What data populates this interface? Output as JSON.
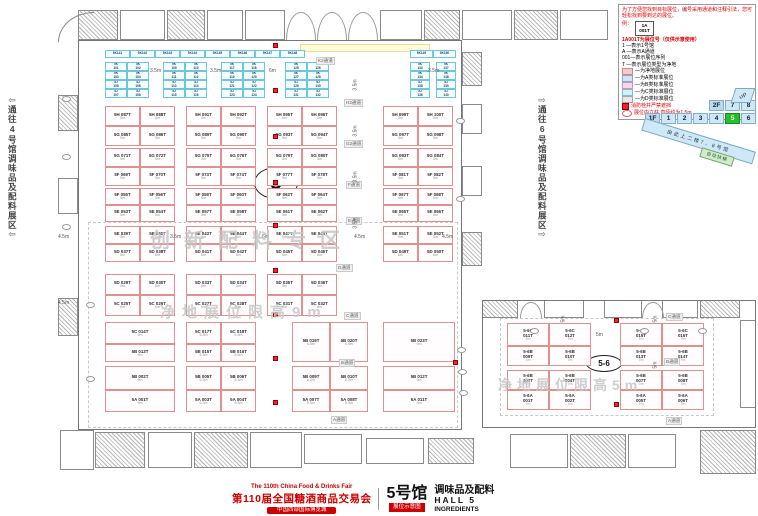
{
  "title_bar": {
    "fair_en": "The 110th China Food & Drinks Fair",
    "fair_cn": "第110届全国糖酒商品交易会",
    "venue": "中国西部国际博览城",
    "hall_big": "5号馆",
    "badge": "展位示意图",
    "hall_cn": "调味品及配料",
    "hall_en": "HALL 5",
    "hall_sub": "INGREDIENTS"
  },
  "corridors": {
    "left": "通往4号馆调味品及配料展区",
    "right": "通往6号馆调味品及配料展区",
    "left_arrow": "⇦",
    "right_arrow": "⇨"
  },
  "hall_marks": {
    "main": "5",
    "connector": "5-6"
  },
  "legend": {
    "intro": "为了方便您找到目标展位，编号采用通道和注释引法，您可轻松找到要到达的展位。",
    "example_label": "例：",
    "example_line1": "1A",
    "example_line2": "001T",
    "title": "1A001T为展位号（仅供示意使用）",
    "code_lines": [
      "1 —表示1号馆",
      "A —表示A通道",
      "001—表示展位序列",
      "T —表示展位类型为净地"
    ],
    "key": [
      {
        "c": "#f6caca",
        "b": "#d08888",
        "t": "—为净地展位"
      },
      {
        "c": "#cfe6f7",
        "b": "#88a8c8",
        "t": "—为A类标准展位"
      },
      {
        "c": "#fbd7e9",
        "b": "#d391b4",
        "t": "—为B类标准展位"
      },
      {
        "c": "#d4f3f8",
        "b": "#7fbccc",
        "t": "—为C类标准展位"
      },
      {
        "c": "#e9e9e9",
        "b": "#a8a8a8",
        "t": "—为D类标准展位"
      }
    ],
    "fire_note": "消防栓井严禁遮挡",
    "pillar_note": "展位内立柱 直径约为1.5m"
  },
  "floor_nav": {
    "row1_label": "2F",
    "row1": [
      "7",
      "8"
    ],
    "row2_label": "1F",
    "row2": [
      "1",
      "2",
      "3",
      "4",
      "5",
      "6"
    ],
    "active": "5",
    "active_color": "#22c32a"
  },
  "ramp": {
    "banner": "由此上二楼7、8号馆",
    "escalator": "自动扶梯",
    "up": "up"
  },
  "watermarks": [
    {
      "text": "创新配料专区",
      "x": 150,
      "y": 224,
      "fs": 20,
      "ls": 14
    },
    {
      "text": "净地展位限高9m",
      "x": 160,
      "y": 301,
      "fs": 15,
      "ls": 7
    },
    {
      "text": "净地展位限高5m",
      "x": 498,
      "y": 375,
      "fs": 14,
      "ls": 5
    }
  ],
  "aisles": [
    {
      "t": "K2通道",
      "x": 316,
      "y": 57
    },
    {
      "t": "H2通道",
      "x": 344,
      "y": 99
    },
    {
      "t": "G2通道",
      "x": 344,
      "y": 140
    },
    {
      "t": "F通道",
      "x": 346,
      "y": 181
    },
    {
      "t": "E通道",
      "x": 346,
      "y": 217
    },
    {
      "t": "D通道",
      "x": 336,
      "y": 264
    },
    {
      "t": "C通道",
      "x": 344,
      "y": 312
    },
    {
      "t": "B通道",
      "x": 339,
      "y": 359
    },
    {
      "t": "A通道",
      "x": 331,
      "y": 416
    },
    {
      "t": "C通道",
      "x": 666,
      "y": 313
    },
    {
      "t": "B通道",
      "x": 664,
      "y": 358
    },
    {
      "t": "A通道",
      "x": 666,
      "y": 417
    }
  ],
  "measures": [
    {
      "t": "3.5m",
      "x": 150,
      "y": 68
    },
    {
      "t": "3.5m",
      "x": 210,
      "y": 68
    },
    {
      "t": "6m",
      "x": 269,
      "y": 68
    },
    {
      "t": "3.5m",
      "x": 428,
      "y": 68
    },
    {
      "t": "4.5m",
      "x": 58,
      "y": 234
    },
    {
      "t": "3.5m",
      "x": 170,
      "y": 234
    },
    {
      "t": "6m",
      "x": 262,
      "y": 234
    },
    {
      "t": "4.5m",
      "x": 354,
      "y": 234
    },
    {
      "t": "4.5m",
      "x": 442,
      "y": 234
    },
    {
      "t": "5m",
      "x": 596,
      "y": 332
    },
    {
      "t": "4.5m",
      "x": 58,
      "y": 300
    }
  ],
  "vmeasures": [
    {
      "t": "3.5m",
      "x": 350,
      "y": 82
    },
    {
      "t": "3.5m",
      "x": 350,
      "y": 128
    },
    {
      "t": "3.5m",
      "x": 350,
      "y": 174
    },
    {
      "t": "3.5m",
      "x": 350,
      "y": 220
    },
    {
      "t": "5m",
      "x": 652,
      "y": 316
    },
    {
      "t": "5m",
      "x": 652,
      "y": 362
    },
    {
      "t": "5m",
      "x": 560,
      "y": 316
    }
  ],
  "plan": {
    "groups_x": [
      105,
      186,
      267,
      383
    ],
    "cell_w": 35,
    "bands": [
      {
        "y": 106,
        "rh": 20,
        "rows": [
          {
            "p": "5H",
            "s": "5m",
            "g": [
              [
                "087T",
                "088T"
              ],
              [
                "091T",
                "092T"
              ],
              [
                "095T",
                "096T"
              ],
              [
                "099T",
                "100T"
              ]
            ]
          },
          {
            "p": "5G",
            "s": "5m",
            "g": [
              [
                "085T",
                "086T"
              ],
              [
                "089T",
                "090T"
              ],
              [
                "093T",
                "094T"
              ],
              [
                "097T",
                "098T"
              ]
            ]
          }
        ]
      },
      {
        "y": 148,
        "rh": 19,
        "rows": [
          {
            "p": "5G",
            "s": "5m",
            "g": [
              [
                "071T",
                "072T"
              ],
              [
                "075T",
                "076T"
              ],
              [
                "079T",
                "080T"
              ],
              [
                "083T",
                "084T"
              ]
            ]
          },
          {
            "p": "5F",
            "s": "5m",
            "g": [
              [
                "069T",
                "070T"
              ],
              [
                "073T",
                "074T"
              ],
              [
                "077T",
                "078T"
              ],
              [
                "081T",
                "082T"
              ]
            ]
          }
        ]
      },
      {
        "y": 188,
        "rh": 17,
        "rows": [
          {
            "p": "5F",
            "s": "5m",
            "g": [
              [
                "055T",
                "056T"
              ],
              [
                "059T",
                "060T"
              ],
              [
                "063T",
                "064T"
              ],
              [
                "067T",
                "068T"
              ]
            ]
          },
          {
            "p": "5E",
            "s": "5m",
            "g": [
              [
                "053T",
                "054T"
              ],
              [
                "057T",
                "058T"
              ],
              [
                "061T",
                "062T"
              ],
              [
                "065T",
                "066T"
              ]
            ]
          }
        ]
      },
      {
        "y": 226,
        "rh": 18,
        "rows": [
          {
            "p": "5E",
            "s": "5m",
            "g": [
              [
                "039T",
                "040T"
              ],
              [
                "043T",
                "044T"
              ],
              [
                "047T",
                "048T"
              ],
              [
                "051T",
                "052T"
              ]
            ]
          },
          {
            "p": "5D",
            "s": "6m",
            "g": [
              [
                "037T",
                "038T"
              ],
              [
                "041T",
                "042T"
              ],
              [
                "045T",
                "046T"
              ],
              [
                "049T",
                "050T"
              ]
            ]
          }
        ]
      },
      {
        "y": 274,
        "rh": 21,
        "rows": [
          {
            "p": "5D",
            "s": "5m",
            "g": [
              [
                "029T",
                "030T"
              ],
              [
                "033T",
                "034T"
              ],
              [
                "035T",
                "036T"
              ],
              []
            ]
          },
          {
            "p": "5C",
            "s": "6m",
            "g": [
              [
                "025T",
                "026T"
              ],
              [
                "027T",
                "028T"
              ],
              [
                "031T",
                "032T"
              ],
              []
            ]
          }
        ]
      }
    ],
    "bottom": [
      {
        "x": 105,
        "w": 70,
        "cells": [
          {
            "p": "5C",
            "n": "014T",
            "y": 322,
            "h": 22,
            "s": "9m"
          },
          {
            "p": "5B",
            "n": "013T",
            "y": 344,
            "h": 18,
            "s": "9m"
          },
          {
            "p": "5B",
            "n": "002T",
            "y": 366,
            "h": 24,
            "s": "9m"
          },
          {
            "p": "5A",
            "n": "001T",
            "y": 390,
            "h": 22,
            "s": "9m"
          }
        ]
      },
      {
        "x": 186,
        "w": 70,
        "cols": [
          {
            "p": "5C",
            "a": "017T",
            "b": "018T",
            "y": 322,
            "h": 22,
            "s": "6.5m"
          },
          {
            "p": "5B",
            "a": "015T",
            "b": "016T",
            "y": 344,
            "h": 18,
            "s": "6.5m"
          },
          {
            "p": "5B",
            "a": "005T",
            "b": "006T",
            "y": 366,
            "h": 24,
            "s": "6.5m"
          },
          {
            "p": "5A",
            "a": "003T",
            "b": "004T",
            "y": 390,
            "h": 22,
            "s": "6.5m"
          }
        ]
      },
      {
        "x": 292,
        "w": 76,
        "cols": [
          {
            "p": "5B",
            "a": "019T",
            "b": "020T",
            "y": 322,
            "h": 40,
            "s": "6.5m"
          },
          {
            "p": "5B",
            "a": "009T",
            "b": "010T",
            "y": 366,
            "h": 24,
            "s": "6.5m"
          },
          {
            "p": "5A",
            "a": "007T",
            "b": "008T",
            "y": 390,
            "h": 22,
            "s": "6.5m"
          }
        ]
      },
      {
        "x": 383,
        "w": 72,
        "cells": [
          {
            "p": "5B",
            "n": "023T",
            "y": 322,
            "h": 40,
            "s": "9m"
          },
          {
            "p": "5B",
            "n": "012T",
            "y": 366,
            "h": 24,
            "s": "9m"
          },
          {
            "p": "5A",
            "n": "011T",
            "y": 390,
            "h": 22,
            "s": "9m"
          }
        ]
      }
    ],
    "hall56": {
      "g1x": 507,
      "g2x": 620,
      "gw": 84,
      "rows": [
        {
          "p": "5-6C",
          "y": 323,
          "h": 23,
          "a": [
            "011T",
            "012T"
          ],
          "b": [
            "015T",
            "016T"
          ],
          "s": "7m"
        },
        {
          "p": "5-6B",
          "y": 346,
          "h": 20,
          "a": [
            "009T",
            "010T"
          ],
          "b": [
            "013T",
            "014T"
          ],
          "s": "7m"
        },
        {
          "p": "5-6B",
          "y": 370,
          "h": 20,
          "a": [
            "003T",
            "004T"
          ],
          "b": [
            "007T",
            "008T"
          ],
          "s": "7m"
        },
        {
          "p": "5-6A",
          "y": 390,
          "h": 20,
          "a": [
            "001T",
            "002T"
          ],
          "b": [
            "005T",
            "006T"
          ],
          "s": "7m"
        }
      ]
    },
    "blue": {
      "top_y": 50,
      "top_h": 8,
      "top": [
        {
          "x": 105,
          "w": 25,
          "ids": [
            "5K141",
            "5K142",
            "5K143",
            "5K144",
            "5K145",
            "5K146",
            "5K147",
            "5K148"
          ]
        },
        {
          "x": 410,
          "w": 23,
          "ids": [
            "5K149",
            "5K150"
          ]
        }
      ],
      "block_y": 62,
      "block_rh": 9,
      "blocks": [
        {
          "x": 105,
          "w": 44
        },
        {
          "x": 163,
          "w": 44
        },
        {
          "x": 221,
          "w": 44
        },
        {
          "x": 285,
          "w": 44
        },
        {
          "x": 410,
          "w": 20
        },
        {
          "x": 436,
          "w": 20
        }
      ],
      "prefixes": [
        "5K",
        "5K",
        "5J",
        "5J"
      ],
      "start_num": 101
    },
    "rooms": [
      [
        78,
        10,
        40,
        30,
        1
      ],
      [
        120,
        10,
        45,
        30,
        0
      ],
      [
        167,
        10,
        38,
        30,
        1
      ],
      [
        207,
        10,
        36,
        30,
        0
      ],
      [
        245,
        10,
        40,
        30,
        0
      ],
      [
        380,
        10,
        42,
        30,
        0
      ],
      [
        424,
        10,
        36,
        30,
        1
      ],
      [
        462,
        10,
        50,
        30,
        0
      ],
      [
        514,
        10,
        44,
        30,
        1
      ],
      [
        560,
        10,
        48,
        30,
        0
      ],
      [
        58,
        95,
        20,
        36,
        1
      ],
      [
        58,
        178,
        20,
        36,
        0
      ],
      [
        58,
        298,
        20,
        38,
        1
      ],
      [
        462,
        52,
        20,
        34,
        1
      ],
      [
        462,
        104,
        20,
        30,
        0
      ],
      [
        462,
        166,
        20,
        30,
        0
      ],
      [
        462,
        232,
        20,
        34,
        1
      ],
      [
        482,
        300,
        36,
        18,
        1
      ],
      [
        544,
        300,
        40,
        18,
        0
      ],
      [
        604,
        300,
        38,
        18,
        0
      ],
      [
        662,
        300,
        36,
        18,
        0
      ],
      [
        700,
        300,
        40,
        18,
        1
      ],
      [
        740,
        320,
        16,
        88,
        0
      ],
      [
        60,
        430,
        34,
        40,
        0
      ],
      [
        95,
        432,
        50,
        36,
        1
      ],
      [
        148,
        432,
        44,
        36,
        0
      ],
      [
        194,
        432,
        54,
        36,
        1
      ],
      [
        250,
        432,
        52,
        36,
        0
      ],
      [
        304,
        434,
        58,
        30,
        0
      ],
      [
        366,
        438,
        58,
        26,
        0
      ],
      [
        428,
        438,
        46,
        26,
        1
      ],
      [
        510,
        434,
        58,
        34,
        0
      ],
      [
        570,
        434,
        56,
        34,
        1
      ],
      [
        628,
        434,
        48,
        34,
        0
      ],
      [
        700,
        430,
        56,
        44,
        1
      ]
    ],
    "arcs": [
      [
        286,
        12,
        30,
        28
      ],
      [
        317,
        12,
        30,
        28
      ],
      [
        348,
        12,
        30,
        28
      ],
      [
        520,
        302,
        22,
        16
      ],
      [
        642,
        302,
        22,
        16
      ]
    ],
    "walls": [
      {
        "x": 78,
        "y": 40,
        "w": 384,
        "h": 390
      },
      {
        "x": 482,
        "y": 300,
        "w": 274,
        "h": 128
      }
    ],
    "dashes": [
      {
        "x": 88,
        "y": 222,
        "w": 370,
        "h": 206
      },
      {
        "x": 500,
        "y": 318,
        "w": 214,
        "h": 98
      }
    ],
    "fires": [
      [
        273,
        43
      ],
      [
        273,
        88
      ],
      [
        273,
        134
      ],
      [
        273,
        180
      ],
      [
        273,
        223
      ],
      [
        273,
        268
      ],
      [
        273,
        312
      ],
      [
        273,
        356
      ],
      [
        273,
        400
      ],
      [
        453,
        360
      ],
      [
        614,
        318
      ],
      [
        614,
        402
      ]
    ],
    "pillars": [
      [
        62,
        96
      ],
      [
        62,
        154
      ],
      [
        62,
        224
      ],
      [
        86,
        302
      ],
      [
        86,
        376
      ],
      [
        456,
        118
      ],
      [
        456,
        196
      ],
      [
        457,
        347
      ],
      [
        458,
        369
      ],
      [
        459,
        390
      ],
      [
        530,
        328
      ],
      [
        640,
        328
      ],
      [
        698,
        328
      ]
    ]
  }
}
